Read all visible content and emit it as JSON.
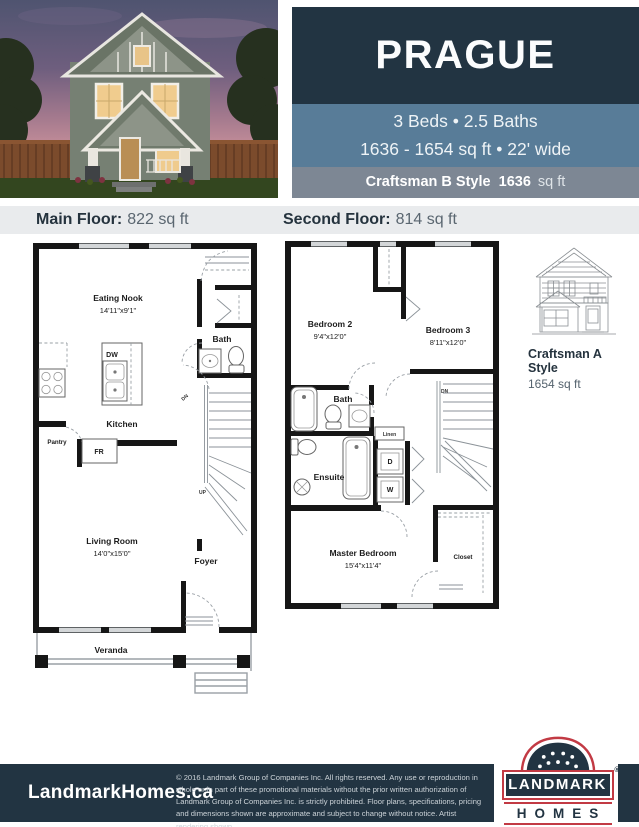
{
  "page": {
    "title": "PRAGUE"
  },
  "colors": {
    "navy": "#223442",
    "slate": "#587c98",
    "steel_gray": "#7d8794",
    "light_band": "#e9ebed",
    "logo_red": "#c23a44",
    "sky_dusk": "#4f5470"
  },
  "header": {
    "plan_name": "PRAGUE",
    "beds_baths": "3 Beds  •  2.5 Baths",
    "size_width": "1636 - 1654 sq ft  •  22' wide",
    "style_name": "Craftsman B Style",
    "style_sqft": "1636",
    "style_unit": "sq ft"
  },
  "floor_labels": {
    "main_label": "Main Floor:",
    "main_sqft": "822 sq ft",
    "second_label": "Second Floor:",
    "second_sqft": "814 sq ft"
  },
  "main_plan": {
    "eating_nook": {
      "name": "Eating Nook",
      "dims": "14'11\"x9'1\""
    },
    "bath": "Bath",
    "dw": "DW",
    "kitchen": "Kitchen",
    "pantry": "Pantry",
    "fridge": "FR",
    "dn": "DN",
    "up": "UP",
    "living_room": {
      "name": "Living Room",
      "dims": "14'0\"x15'0\""
    },
    "foyer": "Foyer",
    "veranda": "Veranda"
  },
  "second_plan": {
    "bedroom2": {
      "name": "Bedroom 2",
      "dims": "9'4\"x12'0\""
    },
    "bedroom3": {
      "name": "Bedroom 3",
      "dims": "8'11\"x12'0\""
    },
    "bath": "Bath",
    "linen": "Linen",
    "ensuite": "Ensuite",
    "dryer": "D",
    "washer": "W",
    "dn": "DN",
    "master": {
      "name": "Master Bedroom",
      "dims": "15'4\"x11'4\""
    },
    "closet": "Closet"
  },
  "alt_style": {
    "line1": "Craftsman A",
    "line2": "Style",
    "sqft": "1654 sq ft"
  },
  "footer": {
    "website": "LandmarkHomes.ca",
    "legal": "© 2016 Landmark Group of Companies Inc. All rights reserved. Any use or reproduction in whole or in part of these promotional materials without the prior written authorization of Landmark Group of Companies Inc. is strictly prohibited. Floor plans, specifications, pricing and dimensions shown are approximate and subject to change without notice. Artist rendering shown.",
    "logo": {
      "top": "LANDMARK",
      "bottom": "HOMES",
      "reg": "®",
      "tagline": "it’s what’s inside"
    }
  }
}
